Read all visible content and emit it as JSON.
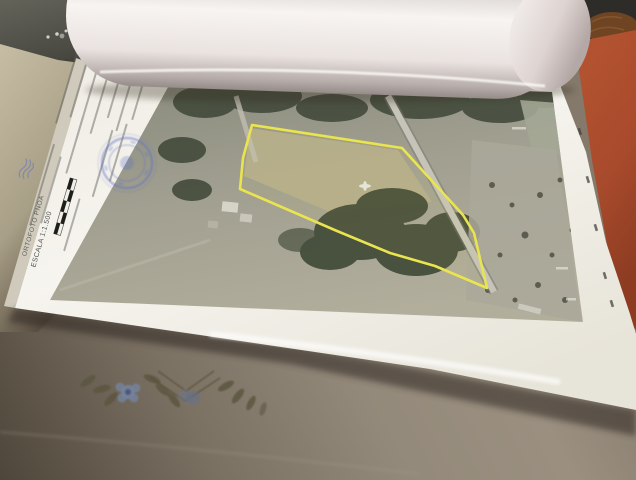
{
  "document": {
    "scale_label": "ESCALA 1:1.500",
    "source_label": "ORTOFOTO PNOA"
  },
  "colors": {
    "parcel_boundary_yellow": "#e9e44f",
    "stamp_blue": "#5a6ec8",
    "cover_terracotta": "#a84a2c",
    "sheet_white": "#f4f2ec",
    "tablecloth_taupe": "#8f8274",
    "embroidery_flower_blue": "#74839f",
    "embroidery_leaf_olive": "#5c5540"
  }
}
